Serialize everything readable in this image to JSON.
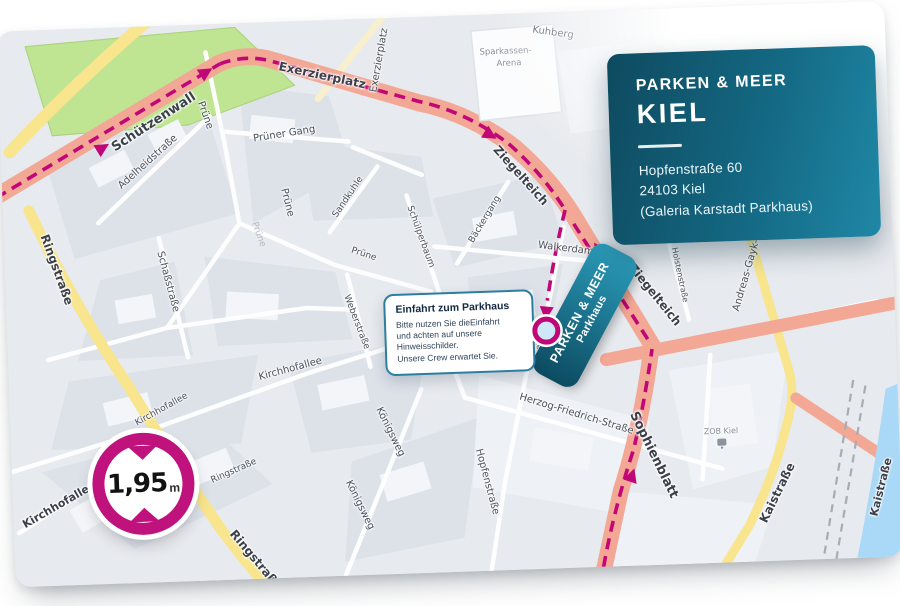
{
  "info_card": {
    "brand": "PARKEN & MEER",
    "city": "KIEL",
    "address_line1": "Hopfenstraße 60",
    "address_line2": "24103 Kiel",
    "address_line3": "(Galeria Karstadt Parkhaus)"
  },
  "tooltip": {
    "title": "Einfahrt zum Parkhaus",
    "body_line1": "Bitte nutzen Sie dieEinfahrt",
    "body_line2": "und achten auf unsere",
    "body_line3": "Hinweisschilder.",
    "body_line4": "Unsere Crew erwartet Sie."
  },
  "parkhaus_pill": {
    "line1": "PARKEN & MEER",
    "line2": "Parkhaus"
  },
  "clearance_badge": {
    "value": "1,95",
    "unit": "m"
  },
  "palette": {
    "card_teal_dark": "#0e4a5f",
    "card_teal_light": "#1f88a6",
    "route_magenta": "#c10677",
    "badge_ring": "#c0127c",
    "road_salmon": "#f3a795",
    "road_yellow": "#f8e58d",
    "park_green": "#bfe492",
    "water_blue": "#a9d9f6",
    "map_background": "#e7eaee"
  },
  "map": {
    "labels": {
      "schuetzenwall": "Schützenwall",
      "exerzierplatz_road": "Exerzierplatz",
      "exerzierplatz_side": "Exerzierplatz",
      "kuhberg": "Kuhberg",
      "ziegelteich_nw": "Ziegelteich",
      "ziegelteich_se": "Ziegelteich",
      "ringstrasse_n": "Ringstraße",
      "ringstrasse_mid": "Ringstraße",
      "ringstrasse_s": "Ringstraße",
      "adelheidstrasse": "Adelheidstraße",
      "pruene_1": "Prüne",
      "pruener_gang": "Prüner Gang",
      "pruene_2": "Prüne",
      "pruene_3": "Prüne",
      "pruene_4": "Prüne",
      "sandkuhle": "Sandkuhle",
      "schuelperbaum": "Schülperbaum",
      "baeckergang": "Bäckergang",
      "walkerdamm": "Walkerdamm",
      "schassstrasse": "Schaßstraße",
      "weberstrasse": "Weberstraße",
      "kirchhofallee_1": "Kirchhofallee",
      "kirchhofallee_2": "Kirchhofallee",
      "kirchhofallee_3": "Kirchhofallee",
      "koenigsweg_1": "Königsweg",
      "koenigsweg_2": "Königsweg",
      "herzog_friedrich": "Herzog-Friedrich-Straße",
      "hopfenstrasse": "Hopfenstraße",
      "hopfenstrasse_small": "Hopfenstraße",
      "sophienblatt": "Sophienblatt",
      "zob_kiel": "ZOB Kiel",
      "kaistrasse_1": "Kaistraße",
      "kaistrasse_2": "Kaistraße",
      "andreas_gayk": "Andreas-Gayk-Str.",
      "holstenstrasse": "Holstenstraße",
      "holstenplatz": "Holstenplatz",
      "bremer": "Bremer-",
      "bremer_platz": "Platz",
      "arena_line1": "Sparkassen-",
      "arena_line2": "Arena"
    }
  }
}
